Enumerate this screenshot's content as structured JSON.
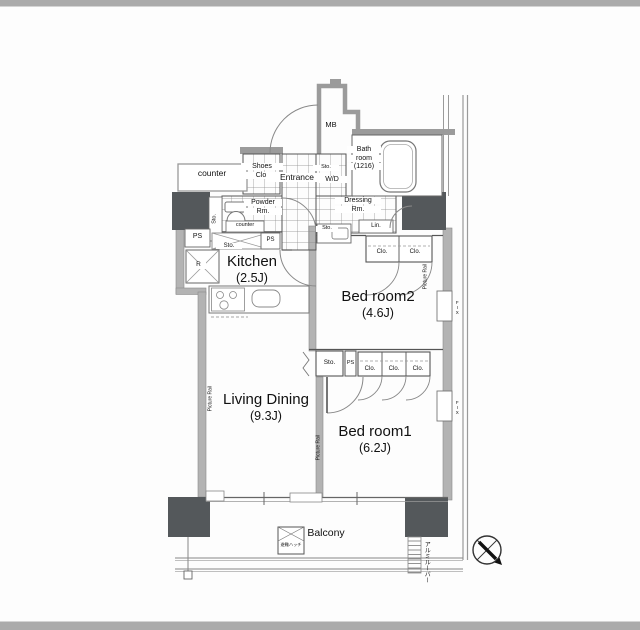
{
  "plan": {
    "counter_top": "counter",
    "shoes_l1": "Shoes",
    "shoes_l2": "Clo.",
    "entrance": "Entrance",
    "wd_sto": "Sto.",
    "wd": "W/D",
    "mb": "MB",
    "bath_l1": "Bath",
    "bath_l2": "room",
    "bath_l3": "(1216)",
    "powder_l1": "Powder",
    "powder_l2": "Rm.",
    "powder_counter": "counter",
    "powder_sto": "Sto.",
    "ps_left": "PS",
    "fridge": "R",
    "kitchen_sto": "Sto.",
    "kitchen_ps": "PS",
    "kitchen_name": "Kitchen",
    "kitchen_size": "(2.5J)",
    "dressing_l1": "Dressing",
    "dressing_l2": "Rm.",
    "dressing_sto": "Sto.",
    "linen": "Lin.",
    "bed2_clo1": "Clo.",
    "bed2_clo2": "Clo.",
    "bed2_name": "Bed room2",
    "bed2_size": "(4.6J)",
    "mid_sto": "Sto.",
    "mid_ps": "PS",
    "mid_clo1": "Clo.",
    "mid_clo2": "Clo.",
    "mid_clo3": "Clo.",
    "living_name": "Living Dining",
    "living_size": "(9.3J)",
    "bed1_name": "Bed room1",
    "bed1_size": "(6.2J)",
    "balcony": "Balcony",
    "hatch_label": "避難ハッチ",
    "louver_label": "アルミルーバー",
    "fix1": "FIX",
    "fix2": "FIX",
    "rail_left": "Picture Rail",
    "rail_mid": "Picture Rail",
    "rail_right": "Picture Rail"
  },
  "colors": {
    "wall_band": "#b3b3b3",
    "wall_outline": "#9b9b9b",
    "pillar": "#54585b",
    "thin_line": "#555555",
    "frame_band": "#ababab"
  }
}
